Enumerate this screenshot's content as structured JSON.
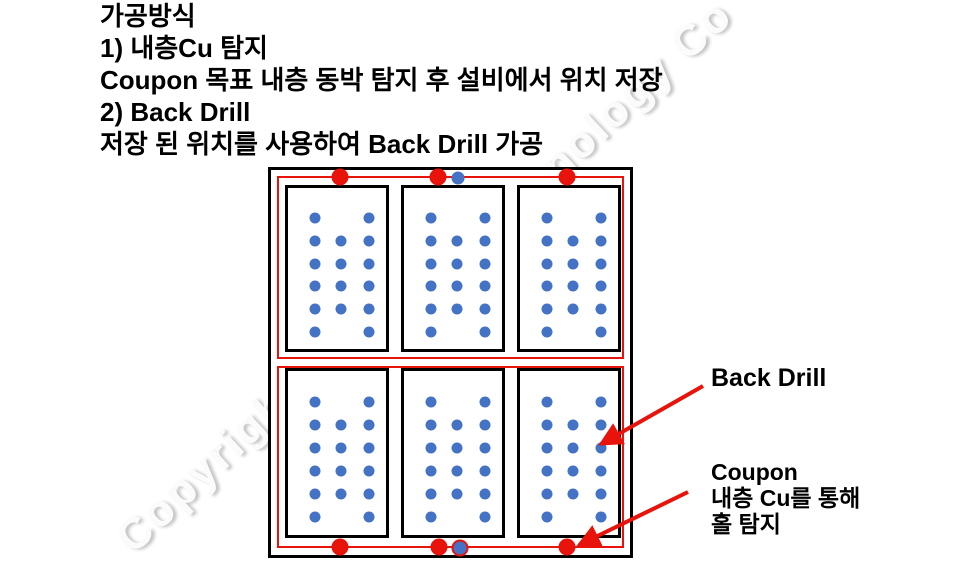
{
  "page": {
    "background": "#ffffff"
  },
  "watermark": {
    "bottom_left_fragment": "Copyright",
    "top_right_fragment": "nology Co"
  },
  "instructions": {
    "lines": [
      "가공방식",
      "1) 내층Cu 탐지",
      "Coupon 목표 내층 동박 탐지 후 설비에서 위치 저장",
      "2) Back Drill",
      "저장 된 위치를 사용하여 Back Drill 가공"
    ]
  },
  "diagram": {
    "description": "panel-with-coupons",
    "colors": {
      "panel_border": "#000000",
      "outline_red": "#e8130a",
      "via_blue": "#4472c4"
    },
    "red_rects": [
      {
        "x": 6,
        "y": 6,
        "w": 347,
        "h": 183
      },
      {
        "x": 6,
        "y": 196,
        "w": 347,
        "h": 182
      }
    ],
    "panels": [
      {
        "x": 14,
        "y": 15,
        "w": 104,
        "h": 167
      },
      {
        "x": 130,
        "y": 15,
        "w": 104,
        "h": 167
      },
      {
        "x": 246,
        "y": 15,
        "w": 104,
        "h": 167
      },
      {
        "x": 14,
        "y": 198,
        "w": 104,
        "h": 170
      },
      {
        "x": 130,
        "y": 198,
        "w": 104,
        "h": 170
      },
      {
        "x": 246,
        "y": 198,
        "w": 104,
        "h": 170
      }
    ],
    "hole_pattern": {
      "rows": 6,
      "cols": 3,
      "col_fracs": [
        0.26,
        0.51,
        0.78
      ],
      "row_fracs": [
        0.18,
        0.316,
        0.452,
        0.588,
        0.724,
        0.86
      ],
      "skip_cells": [
        [
          0,
          1
        ],
        [
          5,
          1
        ]
      ],
      "dot_size": 11
    },
    "tooling_dots": [
      {
        "x": 69,
        "y": 7,
        "type": "red"
      },
      {
        "x": 167,
        "y": 7,
        "type": "red"
      },
      {
        "x": 187,
        "y": 8,
        "type": "blue"
      },
      {
        "x": 296,
        "y": 7,
        "type": "red"
      },
      {
        "x": 69,
        "y": 377,
        "type": "red"
      },
      {
        "x": 168,
        "y": 377,
        "type": "red"
      },
      {
        "x": 189,
        "y": 378,
        "type": "blue-ringed"
      },
      {
        "x": 296,
        "y": 377,
        "type": "red"
      }
    ],
    "tool_red_size": 17,
    "tool_blue_size": 13
  },
  "annotations": {
    "back_drill_label": "Back Drill",
    "coupon_label_lines": [
      "Coupon",
      "내층 Cu를 통해",
      "홀 탐지"
    ],
    "arrow_color": "#e8130a",
    "arrows": [
      {
        "name": "back-drill-arrow",
        "x1": 703,
        "y1": 386,
        "x2": 601,
        "y2": 444
      },
      {
        "name": "coupon-arrow",
        "x1": 688,
        "y1": 492,
        "x2": 579,
        "y2": 545
      }
    ]
  }
}
